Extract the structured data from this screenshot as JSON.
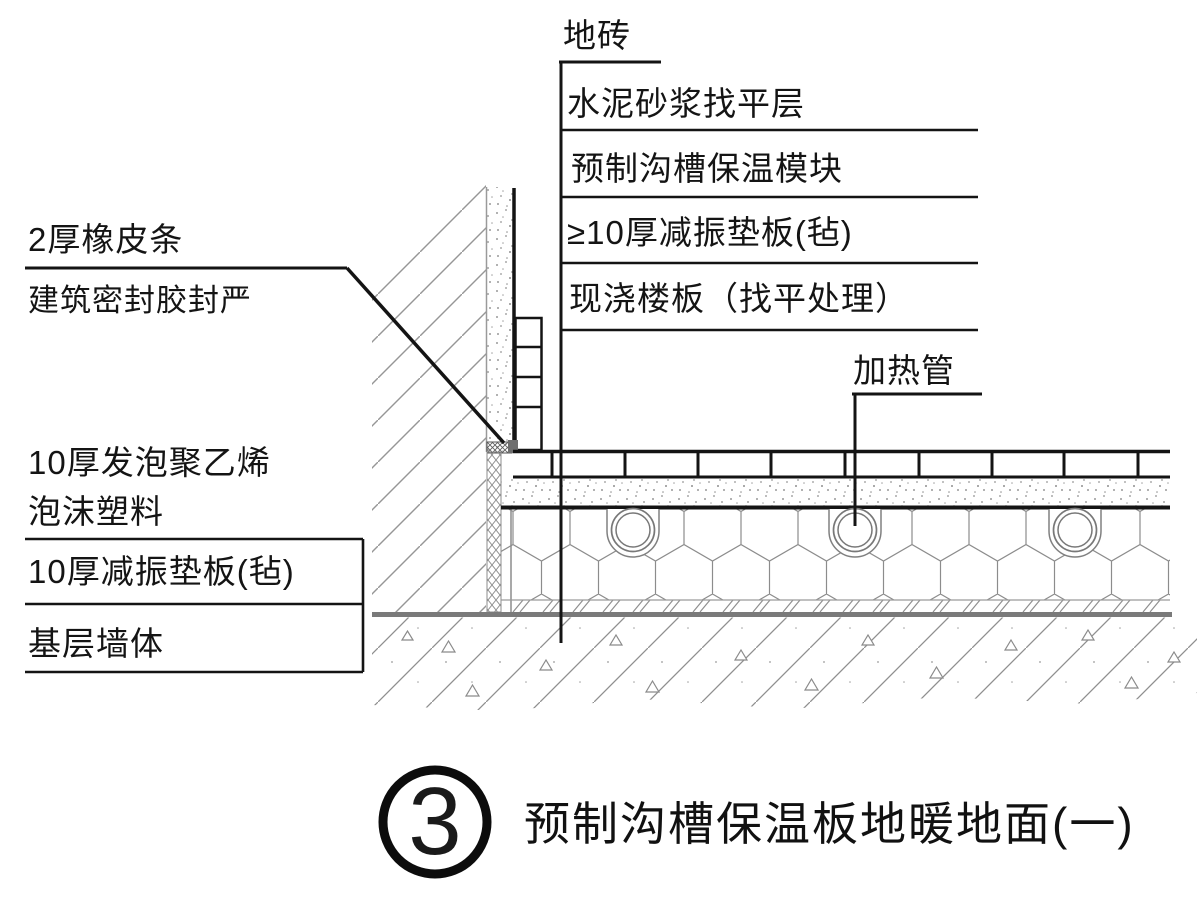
{
  "drawing": {
    "callouts_right": {
      "floor_tile": "地砖",
      "cement_mortar_leveling": "水泥砂浆找平层",
      "precast_groove_insulation_module": "预制沟槽保温模块",
      "damping_pad_min10": "≥10厚减振垫板(毡)",
      "cast_in_situ_slab": "现浇楼板（找平处理）",
      "heating_pipe": "加热管"
    },
    "callouts_left": {
      "rubber_strip": "2厚橡皮条",
      "sealant": "建筑密封胶封严",
      "pe_foam_line1": "10厚发泡聚乙烯",
      "pe_foam_line2": "泡沫塑料",
      "damping_pad_10": "10厚减振垫板(毡)",
      "base_wall": "基层墙体"
    }
  },
  "title_block": {
    "detail_number": "3",
    "detail_title": "预制沟槽保温板地暖地面(一)"
  },
  "colors": {
    "ink": "#141414",
    "hatch_gray": "#8f8f8f",
    "heavy_gray": "#7a7a7a",
    "background": "#ffffff"
  }
}
